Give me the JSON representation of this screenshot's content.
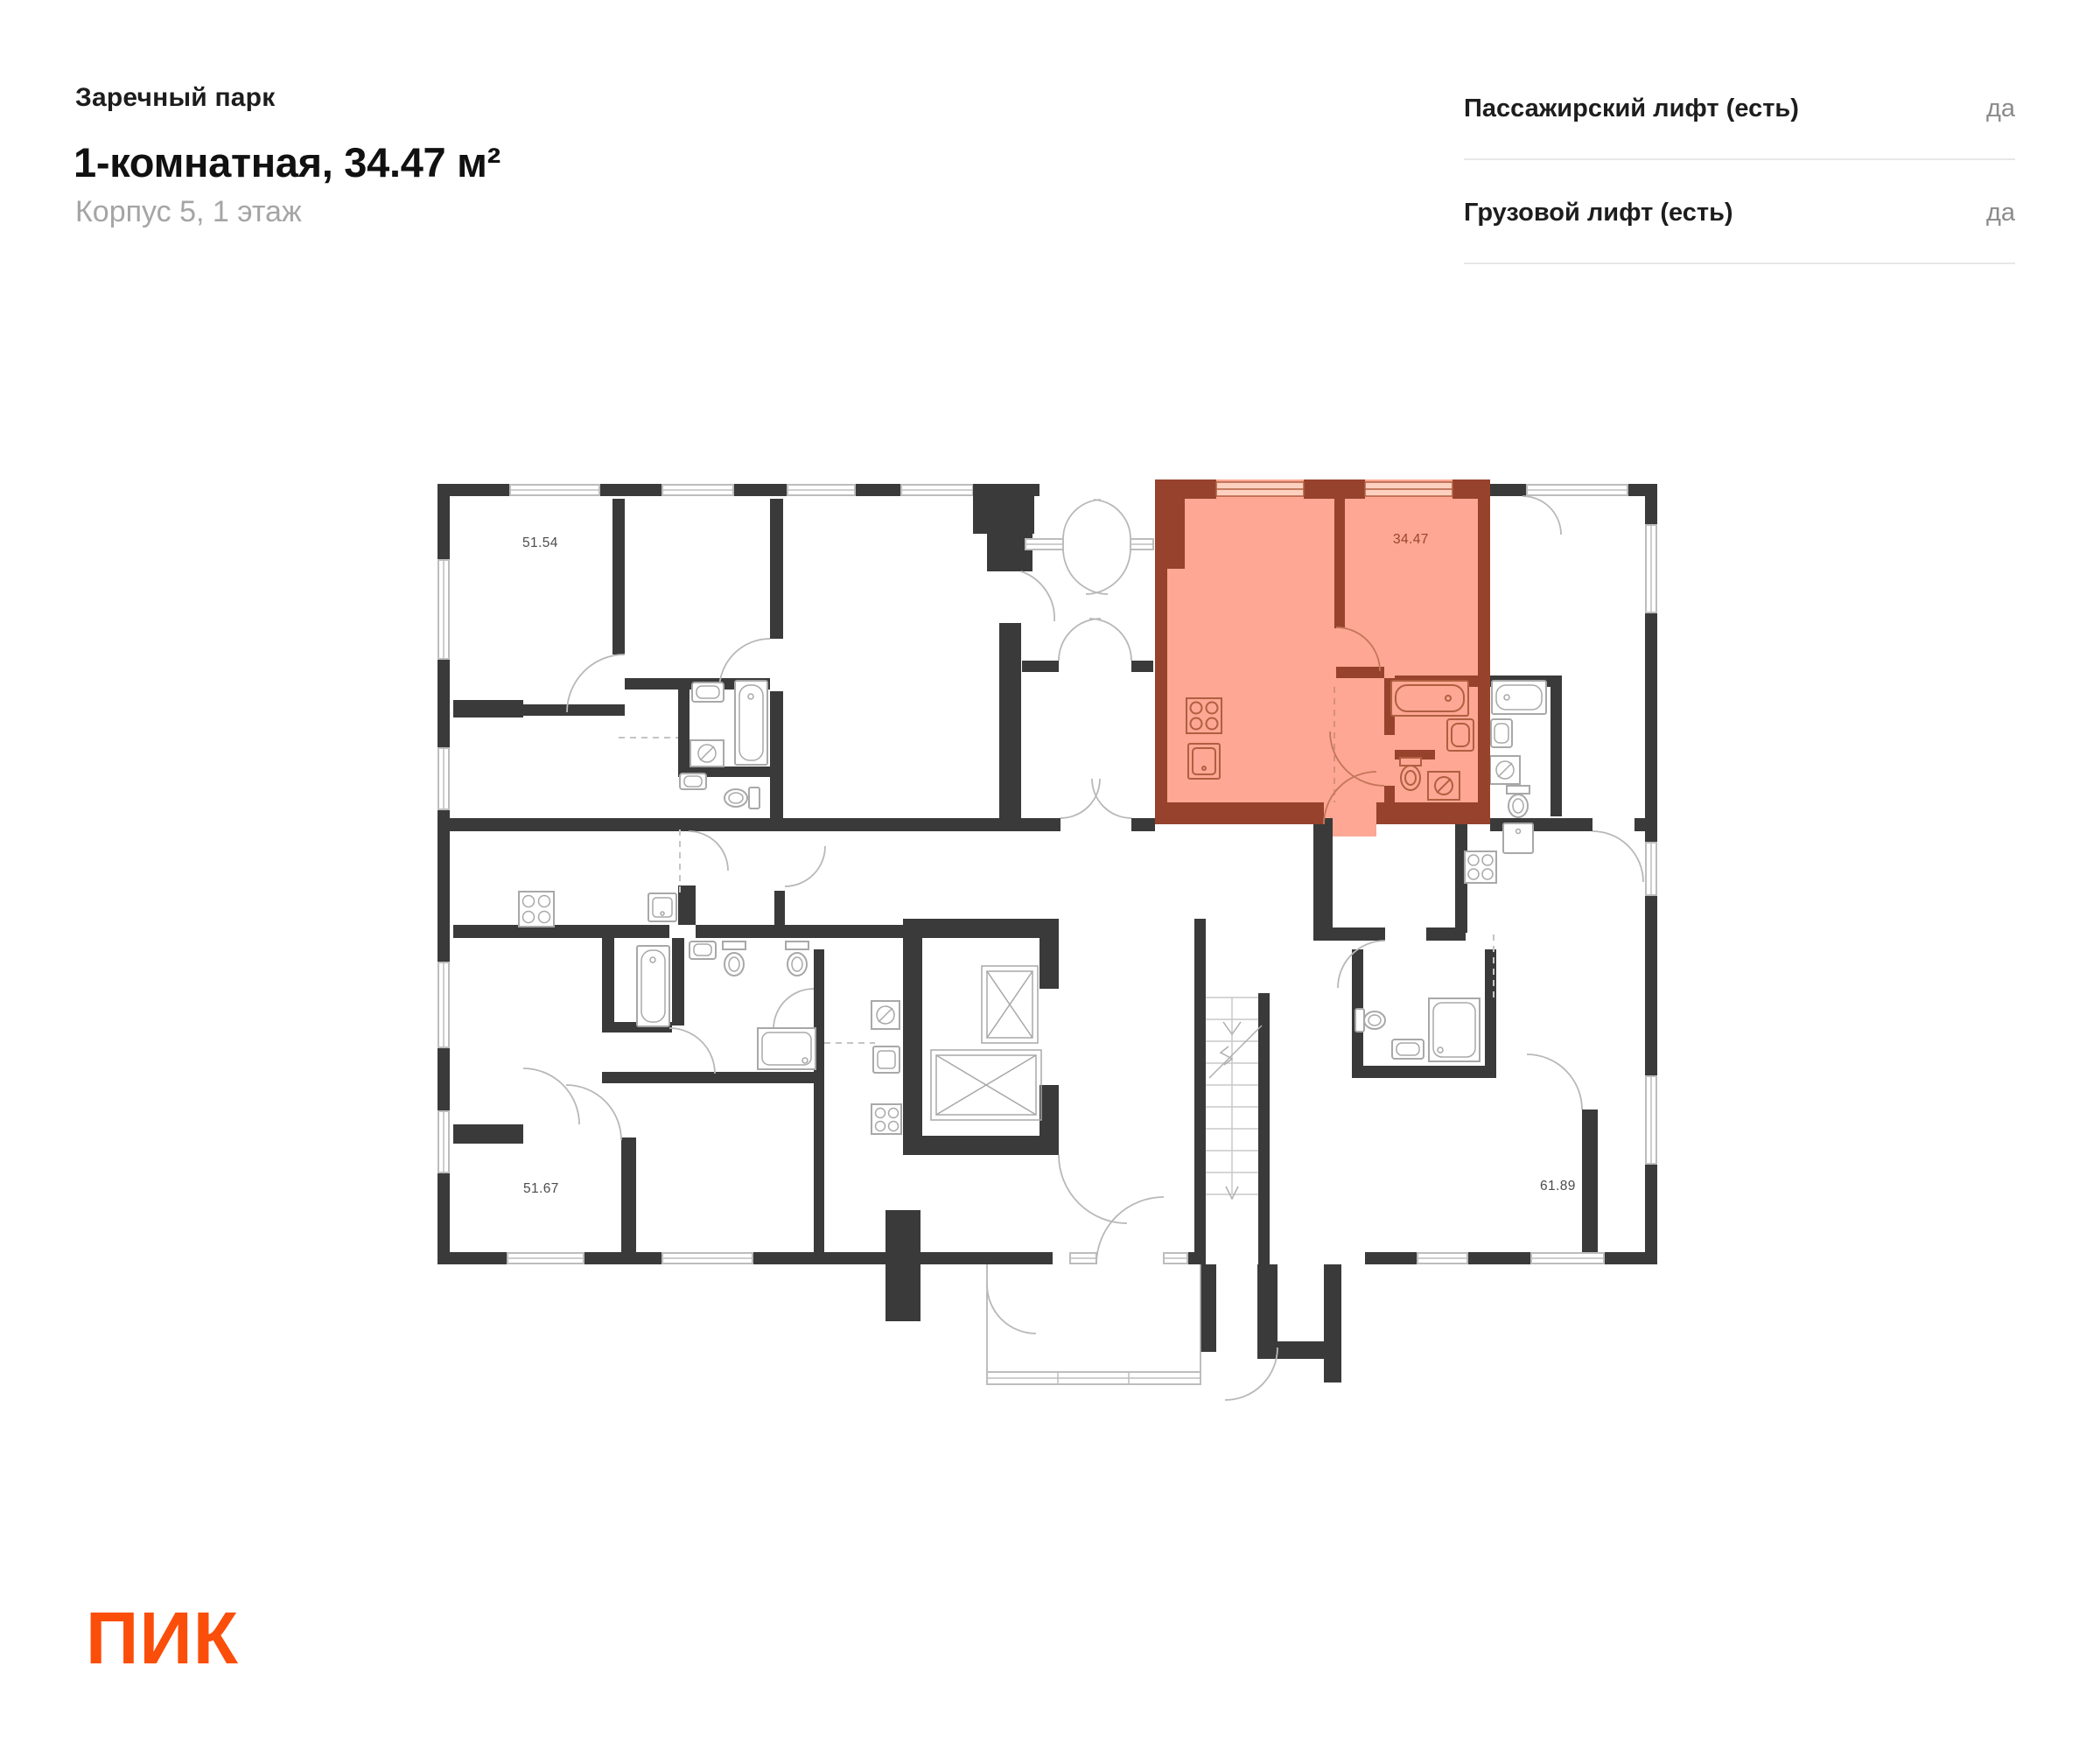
{
  "header": {
    "project": "Заречный парк",
    "title": "1-комнатная, 34.47 м²",
    "subtitle": "Корпус 5, 1 этаж"
  },
  "info_panel": {
    "rows": [
      {
        "label": "Пассажирский лифт (есть)",
        "value": "да"
      },
      {
        "label": "Грузовой лифт (есть)",
        "value": "да"
      }
    ]
  },
  "floorplan": {
    "highlighted_unit": {
      "area": "34.47",
      "rooms": "1",
      "fill_color": "#fda794",
      "wall_color": "#97422c"
    },
    "unit_labels": [
      {
        "text": "51.54"
      },
      {
        "text": "34.47"
      },
      {
        "text": "51.67"
      },
      {
        "text": "61.89"
      }
    ],
    "features": [
      "passenger-elevator",
      "freight-elevator",
      "staircase",
      "entrance-lobby"
    ]
  },
  "logo": {
    "text": "ПИК",
    "color": "#fb4e0a"
  },
  "colors": {
    "wall": "#3a3a3a",
    "accent": "#fb4e0a",
    "highlight": "#fda794",
    "highlight_wall": "#97422c"
  }
}
